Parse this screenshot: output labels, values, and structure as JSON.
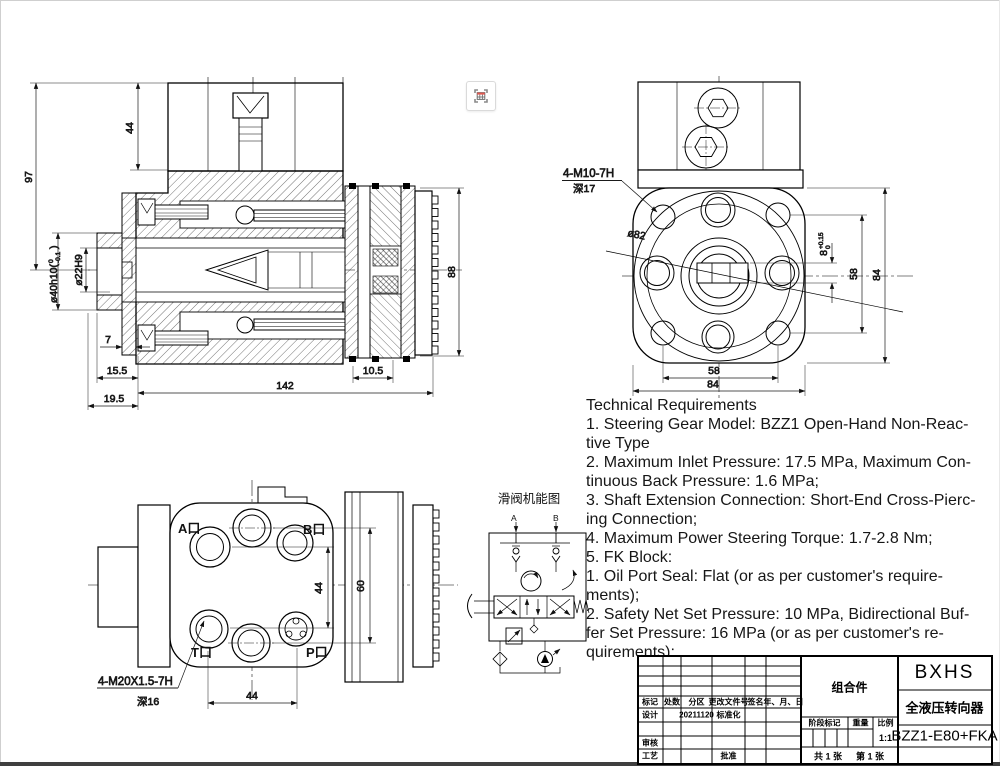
{
  "toolbar": {
    "capture_icon": "table-capture"
  },
  "cross_section": {
    "dim_97": "97",
    "dim_44": "44",
    "dia40_prefix": "ø40h10(",
    "dia40_upper": "0",
    "dia40_lower": "-0.1",
    "dia40_suffix": ")",
    "dia22": "ø22H9",
    "dim_88": "88",
    "dim_7": "7",
    "dim_15_5": "15.5",
    "dim_19_5": "19.5",
    "dim_142": "142",
    "dim_10_5": "10.5"
  },
  "flange": {
    "thread_note": "4-M10-7H",
    "thread_depth": "深17",
    "dia82": "ø82",
    "slot_dim": "8",
    "slot_upper": "+0.15",
    "slot_lower": "0",
    "dim_58_v": "58",
    "dim_84_v": "84",
    "dim_58_b": "58",
    "dim_84_b": "84"
  },
  "ports": {
    "port_a": "A口",
    "port_b": "B口",
    "port_t": "T口",
    "port_p": "P口",
    "dim_44_v": "44",
    "dim_60": "60",
    "dim_44_b": "44",
    "thread_note": "4-M20X1.5-7H",
    "thread_depth": "深16"
  },
  "schematic": {
    "title": "滑阀机能图",
    "label_a": "A",
    "label_b": "B"
  },
  "tech": {
    "lines": [
      "Technical Requirements",
      "1. Steering Gear Model: BZZ1 Open-Hand Non-Reac-",
      "tive Type",
      "2. Maximum Inlet Pressure: 17.5 MPa, Maximum Con-",
      "tinuous Back Pressure: 1.6 MPa;",
      "3. Shaft Extension Connection: Short-End Cross-Pierc-",
      "ing Connection;",
      "4. Maximum Power Steering Torque: 1.7-2.8 Nm;",
      "5. FK Block:",
      "1. Oil Port Seal: Flat (or as per customer's require-",
      "ments);",
      "2. Safety Net Set Pressure: 10 MPa, Bidirectional Buf-",
      "fer Set Pressure: 16 MPa (or as per customer's re-",
      "quirements);"
    ]
  },
  "title_block": {
    "rev_headers": [
      "标记",
      "处数",
      "分区",
      "更改文件号",
      "签名",
      "年、月、日"
    ],
    "design": "设计",
    "design_date": "20211120",
    "standardization": "标准化",
    "check": "审核",
    "process": "工艺",
    "approve": "批准",
    "assembly_type": "组合件",
    "company": "BXHS",
    "product_name": "全液压转向器",
    "stage_mark": "阶段标记",
    "weight": "重量",
    "scale": "比例",
    "scale_value": "1:1",
    "sheet_total": "共 1 张",
    "sheet_no": "第 1 张",
    "model_code": "BZZ1-E80+FKA"
  }
}
